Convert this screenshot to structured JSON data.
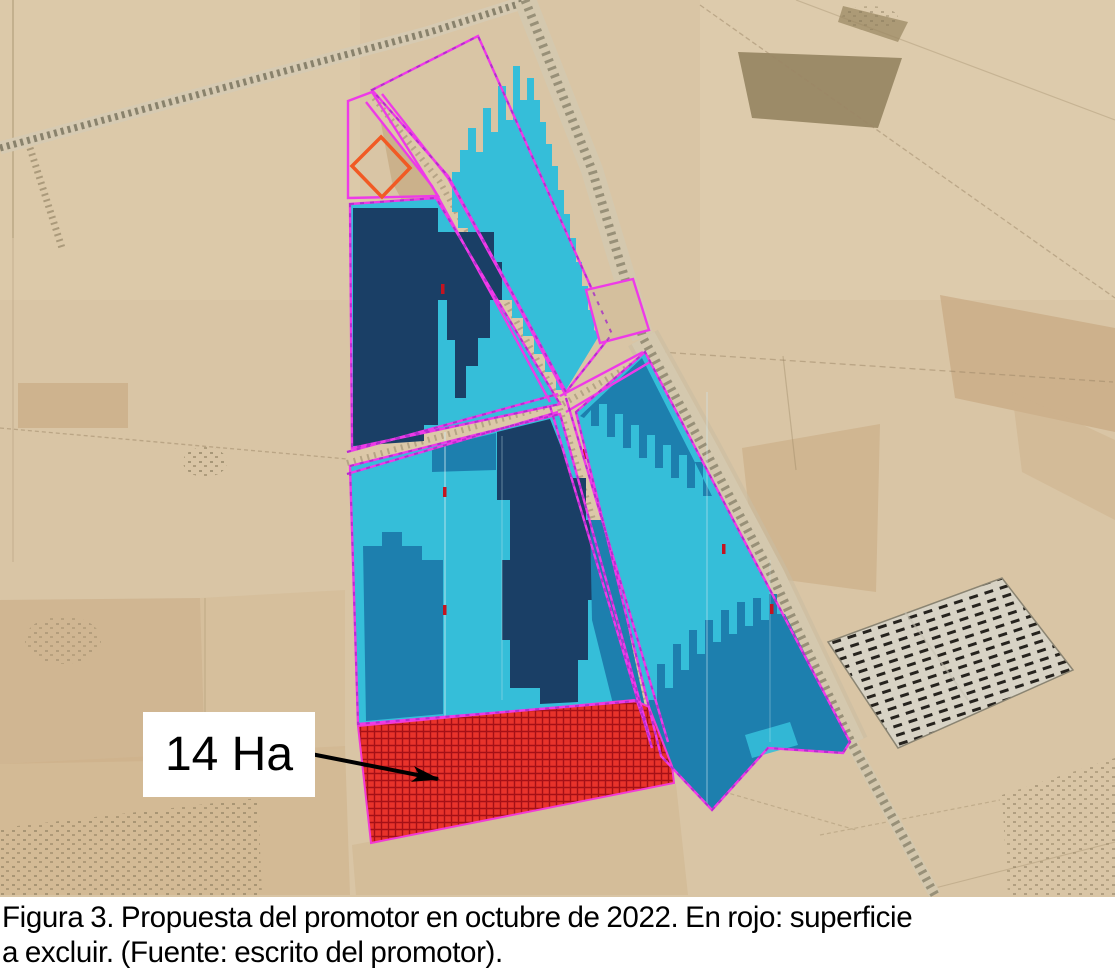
{
  "figure": {
    "caption": {
      "line1": "Figura 3. Propuesta del promotor en octubre de 2022. En rojo: superficie",
      "line2": "a excluir. (Fuente: escrito del promotor)."
    },
    "annotation": {
      "area_label": "14 Ha"
    }
  },
  "map": {
    "type": "satellite-aerial-figure",
    "overlays": [
      {
        "name": "pv-area-light-blue",
        "color": "#35bed9"
      },
      {
        "name": "pv-area-medium-blue",
        "color": "#1d7fae"
      },
      {
        "name": "pv-area-dark-navy",
        "color": "#1a3f66"
      },
      {
        "name": "project-boundary-magenta",
        "color": "#ee3ae8"
      },
      {
        "name": "excluded-area-red-hatch",
        "color": "#e8332b"
      },
      {
        "name": "orange-diamond-marker",
        "color": "#f15a24"
      }
    ]
  },
  "colors": {
    "background_tan": "#d9c5a5",
    "magenta_boundary": "#ee3ae8",
    "magenta_dash": "#a82ac8",
    "cyan_panels": "#35bed9",
    "medium_blue_panels": "#1d7fae",
    "navy_panels": "#1a3f66",
    "red_exclusion": "#e8332b",
    "red_hatch_line": "#a51016",
    "orange_outline": "#f15a24",
    "road_tan": "#dcc8a8",
    "label_bg": "#ffffff",
    "text_color": "#000000"
  }
}
